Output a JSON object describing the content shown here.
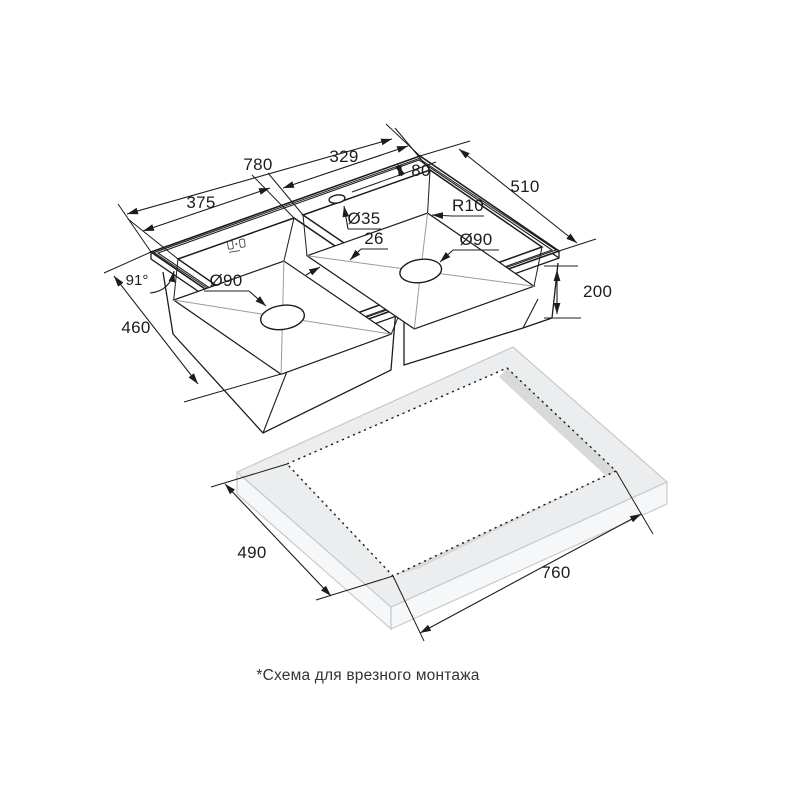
{
  "diagram": {
    "title_hidden": "",
    "caption": "*Схема для врезного монтажа",
    "dims": {
      "overall_width": "780",
      "left_bowl_width": "375",
      "right_bowl_width": "329",
      "faucet_offset": "80",
      "overall_depth": "510",
      "faucet_hole_diameter": "Ø35",
      "divider_width": "26",
      "corner_radius": "R10",
      "drain_left_diameter": "Ø90",
      "drain_right_diameter": "Ø90",
      "wall_angle": "91°",
      "bowl_outer_depth": "460",
      "bowl_height": "200",
      "cutout_depth": "490",
      "cutout_width": "760"
    },
    "colors": {
      "ink": "#1c1c1c",
      "crease": "#9b9b9b",
      "counter_top": "#ecedee",
      "counter_side": "#f6f7f8",
      "counter_edge": "#c7c9ca",
      "cutout_wall": "#d8dada",
      "background": "#ffffff"
    },
    "icons": {
      "brand_mark": "brand-mark-icon"
    }
  }
}
